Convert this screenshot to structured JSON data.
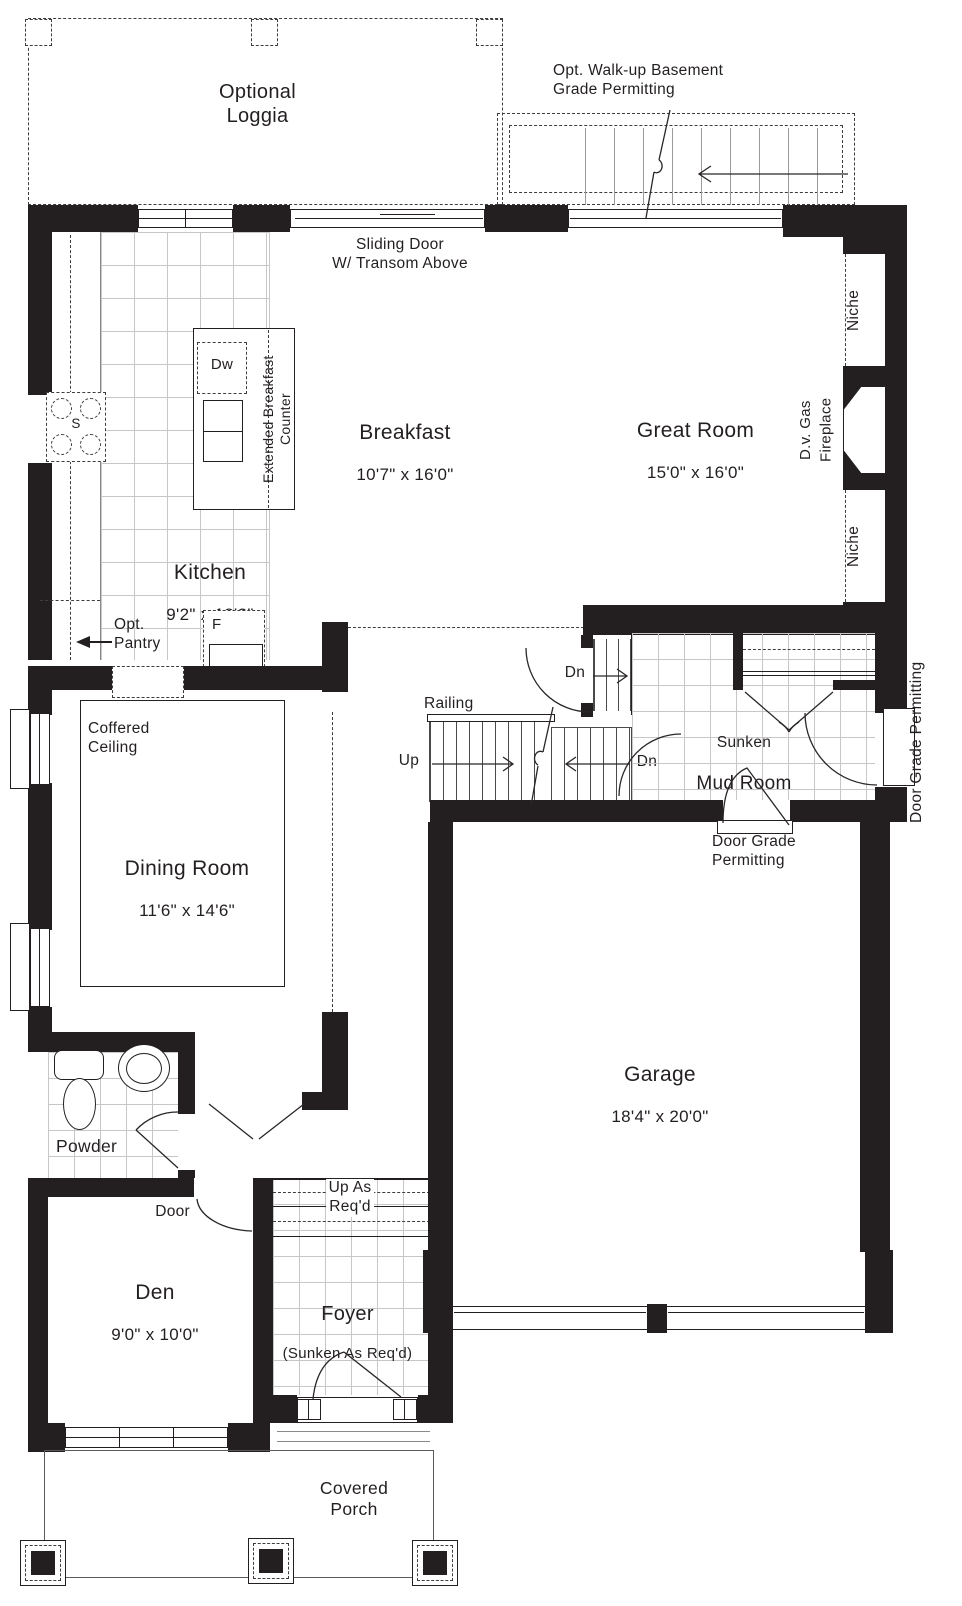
{
  "title": "Main floor plan",
  "colors": {
    "wall": "#231f20",
    "line": "#231f20",
    "dash": "#3d3d3d",
    "tile": "#c7c7c7"
  },
  "outdoor": {
    "loggia": "Optional\nLoggia",
    "walkup": "Opt. Walk-up Basement\nGrade Permitting",
    "porch": "Covered\nPorch"
  },
  "rooms": {
    "breakfast": {
      "name": "Breakfast",
      "dims": "10'7\" x 16'0\""
    },
    "great_room": {
      "name": "Great Room",
      "dims": "15'0\" x 16'0\""
    },
    "kitchen": {
      "name": "Kitchen",
      "dims": "9'2\" x 18'2\""
    },
    "dining": {
      "name": "Dining Room",
      "dims": "11'6\" x 14'6\""
    },
    "mud_room": {
      "prefix": "Sunken",
      "name": "Mud Room"
    },
    "garage": {
      "name": "Garage",
      "dims": "18'4\" x 20'0\""
    },
    "den": {
      "name": "Den",
      "dims": "9'0\" x 10'0\""
    },
    "foyer": {
      "name": "Foyer",
      "note": "(Sunken As Req'd)"
    },
    "powder": {
      "name": "Powder"
    }
  },
  "features": {
    "sliding_door": "Sliding Door\nW/ Transom Above",
    "niche_top": "Niche",
    "niche_bottom": "Niche",
    "fireplace": "D.v. Gas\nFireplace",
    "counter": "Extended Breakfast Counter",
    "coffered": "Coffered\nCeiling",
    "pantry": "Opt.\nPantry",
    "railing": "Railing",
    "french_door": "French\nDoor",
    "up_as_reqd": "Up As\nReq'd",
    "door_grade_side": "Door Grade Permitting",
    "door_grade_garage": "Door Grade\nPermitting"
  },
  "appliances": {
    "dishwasher": "Dw",
    "stove": "S",
    "fridge": "F"
  },
  "stairs": {
    "up": "Up",
    "down_basement": "Dn",
    "down_lower": "Dn"
  }
}
